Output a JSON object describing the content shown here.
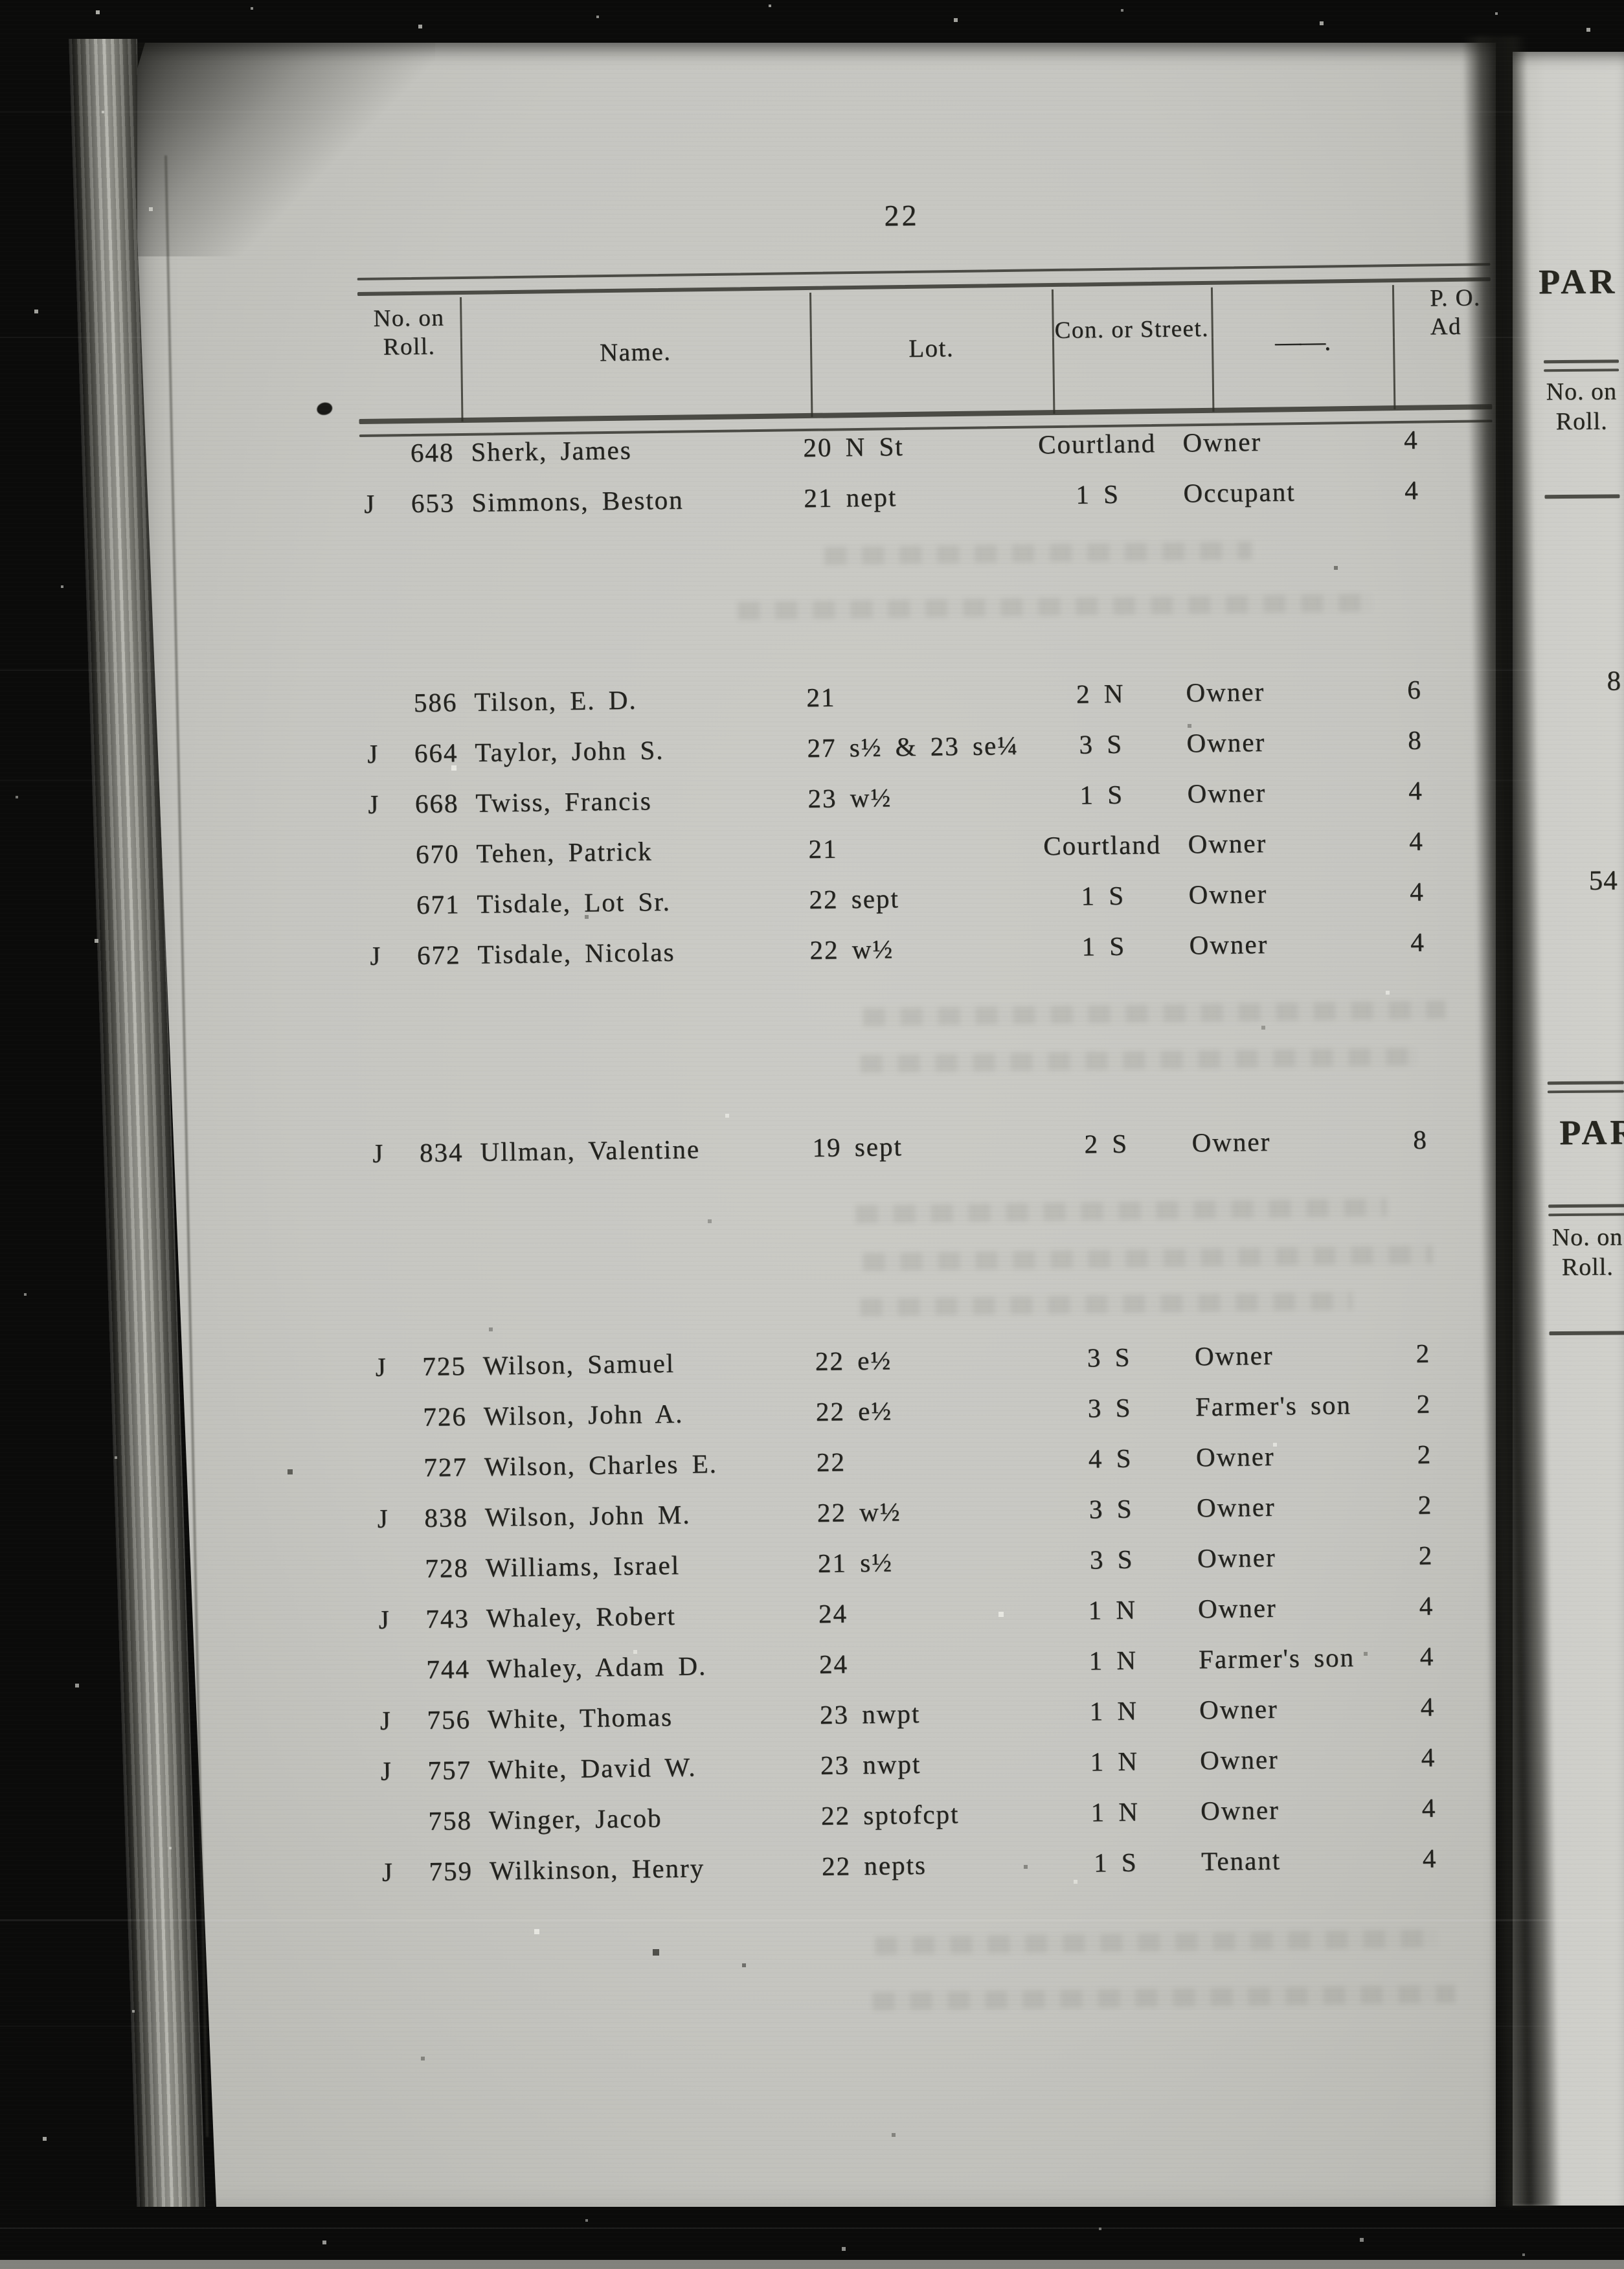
{
  "page": {
    "number": "22"
  },
  "table": {
    "headers": {
      "no_on_roll": "No. on Roll.",
      "name": "Name.",
      "lot": "Lot.",
      "con_or_street": "Con. or Street.",
      "dash": "——.",
      "po_address": "P. O. Ad"
    },
    "rows": [
      {
        "flag": "",
        "no": "648",
        "name": "Sherk, James",
        "lot": "20 N St",
        "con": "Courtland",
        "status": "Owner",
        "po": "4"
      },
      {
        "flag": "J",
        "no": "653",
        "name": "Simmons, Beston",
        "lot": "21 nept",
        "con": "1 S",
        "status": "Occupant",
        "po": "4"
      },
      {
        "flag": "",
        "no": "586",
        "name": "Tilson, E. D.",
        "lot": "21",
        "con": "2 N",
        "status": "Owner",
        "po": "6",
        "section_break": true
      },
      {
        "flag": "J",
        "no": "664",
        "name": "Taylor, John S.",
        "lot": "27 s½ & 23 se¼",
        "con": "3 S",
        "status": "Owner",
        "po": "8"
      },
      {
        "flag": "J",
        "no": "668",
        "name": "Twiss, Francis",
        "lot": "23 w½",
        "con": "1 S",
        "status": "Owner",
        "po": "4"
      },
      {
        "flag": "",
        "no": "670",
        "name": "Tehen, Patrick",
        "lot": "21",
        "con": "Courtland",
        "status": "Owner",
        "po": "4"
      },
      {
        "flag": "",
        "no": "671",
        "name": "Tisdale, Lot Sr.",
        "lot": "22 sept",
        "con": "1 S",
        "status": "Owner",
        "po": "4"
      },
      {
        "flag": "J",
        "no": "672",
        "name": "Tisdale, Nicolas",
        "lot": "22 w½",
        "con": "1 S",
        "status": "Owner",
        "po": "4"
      },
      {
        "flag": "J",
        "no": "834",
        "name": "Ullman, Valentine",
        "lot": "19 sept",
        "con": "2 S",
        "status": "Owner",
        "po": "8",
        "section_break": true
      },
      {
        "flag": "J",
        "no": "725",
        "name": "Wilson, Samuel",
        "lot": "22 e½",
        "con": "3 S",
        "status": "Owner",
        "po": "2",
        "section_break": true
      },
      {
        "flag": "",
        "no": "726",
        "name": "Wilson, John A.",
        "lot": "22 e½",
        "con": "3 S",
        "status": "Farmer's son",
        "po": "2"
      },
      {
        "flag": "",
        "no": "727",
        "name": "Wilson, Charles E.",
        "lot": "22",
        "con": "4 S",
        "status": "Owner",
        "po": "2"
      },
      {
        "flag": "J",
        "no": "838",
        "name": "Wilson, John M.",
        "lot": "22 w½",
        "con": "3 S",
        "status": "Owner",
        "po": "2"
      },
      {
        "flag": "",
        "no": "728",
        "name": "Williams, Israel",
        "lot": "21 s½",
        "con": "3 S",
        "status": "Owner",
        "po": "2"
      },
      {
        "flag": "J",
        "no": "743",
        "name": "Whaley, Robert",
        "lot": "24",
        "con": "1 N",
        "status": "Owner",
        "po": "4"
      },
      {
        "flag": "",
        "no": "744",
        "name": "Whaley, Adam D.",
        "lot": "24",
        "con": "1 N",
        "status": "Farmer's son",
        "po": "4"
      },
      {
        "flag": "J",
        "no": "756",
        "name": "White, Thomas",
        "lot": "23 nwpt",
        "con": "1 N",
        "status": "Owner",
        "po": "4"
      },
      {
        "flag": "J",
        "no": "757",
        "name": "White, David W.",
        "lot": "23 nwpt",
        "con": "1 N",
        "status": "Owner",
        "po": "4"
      },
      {
        "flag": "",
        "no": "758",
        "name": "Winger, Jacob",
        "lot": "22 sptofcpt",
        "con": "1 N",
        "status": "Owner",
        "po": "4"
      },
      {
        "flag": "J",
        "no": "759",
        "name": "Wilkinson, Henry",
        "lot": "22 nepts",
        "con": "1 S",
        "status": "Tenant",
        "po": "4"
      }
    ]
  },
  "right_page": {
    "heading_top": "PAR",
    "roll_header_top": "No. on Roll.",
    "number_top": "8",
    "number_mid": "54",
    "heading_mid": "PAR",
    "roll_header_mid": "No. on Roll."
  }
}
